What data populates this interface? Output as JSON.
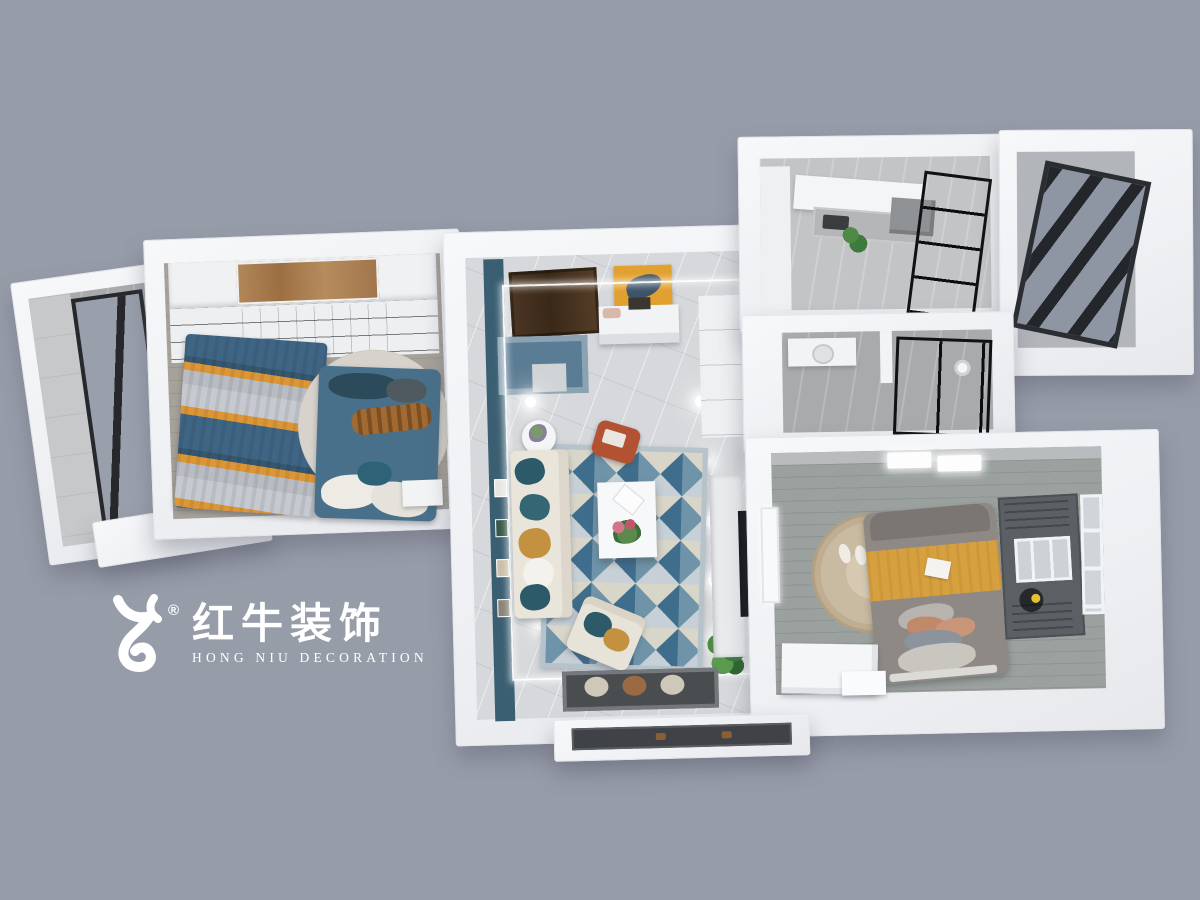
{
  "canvas": {
    "background_color": "#979ca9"
  },
  "watermark": {
    "registered": "®",
    "brand_cn": "红牛装饰",
    "brand_en": "HONG NIU DECORATION",
    "text_color": "#ffffff",
    "icon": "hongniu-bull-icon"
  },
  "scene": {
    "type": "aerial-3d-floorplan-render",
    "wall_color": "#f2f3f5",
    "rooms": [
      {
        "id": "balcony-left",
        "floor": "#b7babe",
        "accents": [
          "#26282c",
          "#99a0ac"
        ]
      },
      {
        "id": "master-bedroom",
        "floor": "#a6a199",
        "accents": [
          "#3e6584",
          "#dd9636",
          "#49708a",
          "#b2875a"
        ]
      },
      {
        "id": "living-room",
        "floor": "#d6d8db",
        "accents": [
          "#3b5f72",
          "#b25232",
          "#e2a02e",
          "#2c5a68"
        ]
      },
      {
        "id": "kitchen",
        "floor": "#c2c4c6",
        "accents": [
          "#1f2227",
          "#b4b6b8"
        ]
      },
      {
        "id": "bathroom",
        "floor": "#a8aaac",
        "accents": [
          "#1d2025"
        ]
      },
      {
        "id": "balcony-right",
        "floor": "#b2b6bb",
        "accents": [
          "#23262b"
        ]
      },
      {
        "id": "bedroom-2",
        "floor": "#9ba19e",
        "accents": [
          "#d7a03e",
          "#8e8985",
          "#cdbda4"
        ]
      },
      {
        "id": "hallway",
        "floor": "#d6d8db"
      }
    ]
  }
}
